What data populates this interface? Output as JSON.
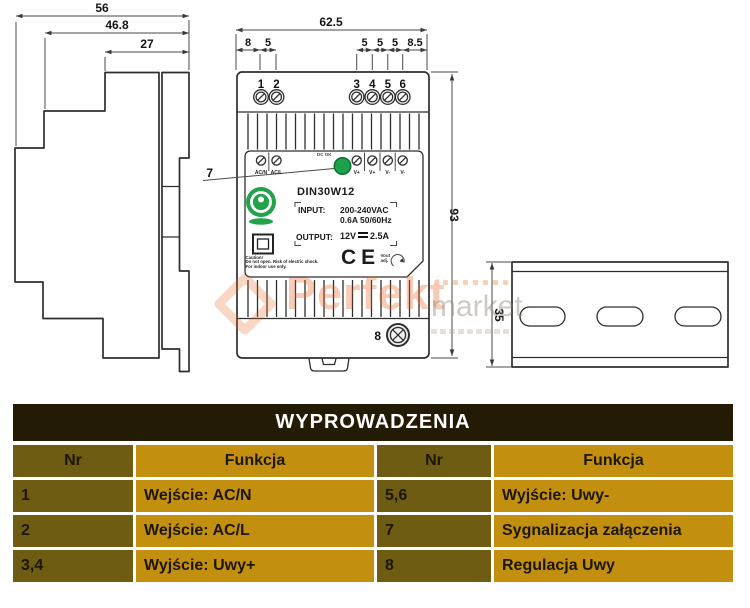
{
  "drawing": {
    "dims": {
      "side_total": "56",
      "side_mid": "46.8",
      "side_top": "27",
      "front_width": "62.5",
      "front_seg_left": [
        "8",
        "5"
      ],
      "front_seg_right": [
        "5",
        "5",
        "5",
        "8.5"
      ],
      "front_height": "93",
      "rail_width": "35"
    },
    "terminals": {
      "numbers": [
        "1",
        "2",
        "3",
        "4",
        "5",
        "6"
      ],
      "labels": [
        "AC/N",
        "AC/L",
        "V+",
        "V+",
        "V-",
        "V-"
      ]
    },
    "callouts": {
      "led": "7",
      "adjust": "8"
    },
    "label": {
      "model": "DIN30W12",
      "input_label": "INPUT:",
      "input_line1": "200-240VAC",
      "input_line2": "0.6A  50/60Hz",
      "output_label": "OUTPUT:",
      "output_value": "12V",
      "output_amps": "2.5A",
      "dc_ok": "DC OK",
      "ce_mark": "CE",
      "adjust": "Vout adj.",
      "caution_line1": "Caution!",
      "caution_line2": "Do not open. Risk of electric shock.",
      "caution_line3": "For indoor use only."
    }
  },
  "watermark": {
    "bold": "Perfekt",
    "light": "market"
  },
  "table": {
    "title": "WYPROWADZENIA",
    "headers": [
      "Nr",
      "Funkcja",
      "Nr",
      "Funkcja"
    ],
    "rows": [
      [
        "1",
        "Wejście: AC/N",
        "5,6",
        "Wyjście: Uwy-"
      ],
      [
        "2",
        "Wejście: AC/L",
        "7",
        "Sygnalizacja załączenia"
      ],
      [
        "3,4",
        "Wyjście: Uwy+",
        "8",
        "Regulacja Uwy"
      ]
    ]
  },
  "colors": {
    "table_gold": "#c2900e",
    "table_olive": "#6d5c12",
    "table_title_bg": "#241b04",
    "table_text": "#1d1604",
    "separator_white": "#ffffff",
    "led_green": "#1ca24b",
    "logo_green": "#22a24b",
    "watermark_orange": "#e8661f",
    "line_dark": "#2e2e2e"
  }
}
